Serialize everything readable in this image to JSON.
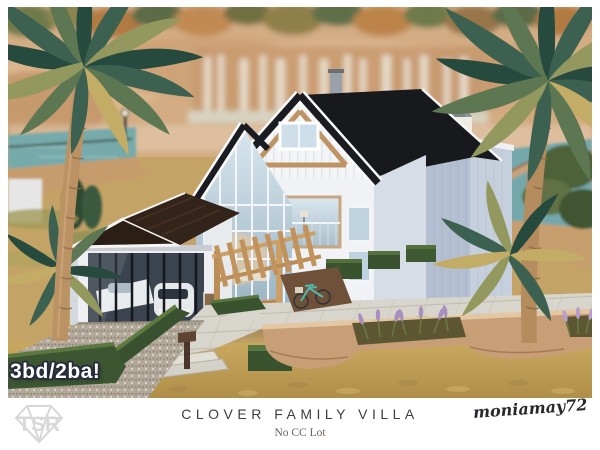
{
  "photo": {
    "badge": "3bd/2ba!"
  },
  "caption": {
    "title": "CLOVER FAMILY VILLA",
    "subtitle": "No CC Lot",
    "signature": "moniamay72",
    "watermark": "TSR"
  },
  "palette": {
    "frame_white": "#ffffff",
    "title_text": "#3e3d3f",
    "subtitle_text": "#6b6156",
    "signature_text": "#28282f",
    "watermark_gray": "#d9d9d9",
    "badge_text": "#ffffff",
    "badge_outline": "#272c3c",
    "cliff_tan": "#d3ac83",
    "water_teal": "#76aaab",
    "roof_dark": "#17191d",
    "garage_roof_brown": "#2b1e15",
    "wood_trim": "#bf9464",
    "house_wall_white": "#f0f2f5",
    "glass_blue": "#a3bcca",
    "hedge_green": "#3a532f",
    "sand_olive": "#bb9a55",
    "paver_gray": "#d8d5cc",
    "garden_wall_tan": "#c89e76",
    "lavender_purple": "#a88fc0",
    "palm_frond_green": "#3c6150",
    "palm_trunk_tan": "#b58c5e",
    "bike_teal": "#52b9ad"
  }
}
